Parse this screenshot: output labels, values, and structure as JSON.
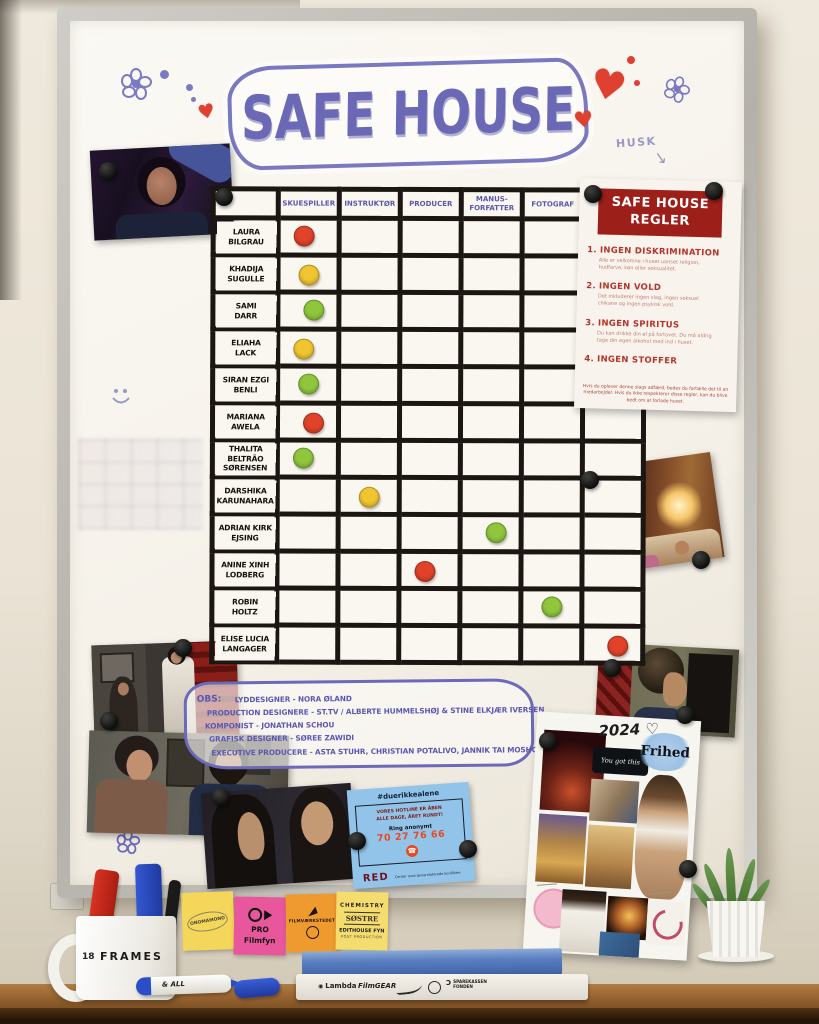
{
  "board": {
    "title": "SAFE HOUSE",
    "husk_label": "HUSK",
    "grid": {
      "columns": [
        "SKUESPILLER",
        "INSTRUKTØR",
        "PRODUCER",
        "MANUS-\nFORFATTER",
        "FOTOGRAF",
        "KLIPPER"
      ],
      "rows": [
        {
          "name": "LAURA\nBILGRAU",
          "dot": {
            "col": 0,
            "color": "#e0432a"
          }
        },
        {
          "name": "KHADIJA\nSUGULLE",
          "dot": {
            "col": 0,
            "color": "#f0c531"
          }
        },
        {
          "name": "SAMI\nDARR",
          "dot": {
            "col": 0,
            "color": "#8fc63c"
          }
        },
        {
          "name": "ELIAHA\nLACK",
          "dot": {
            "col": 0,
            "color": "#f0c531"
          }
        },
        {
          "name": "SIRAN EZGI\nBENLI",
          "dot": {
            "col": 0,
            "color": "#8fc63c"
          }
        },
        {
          "name": "MARIANA\nAWELA",
          "dot": {
            "col": 0,
            "color": "#e0432a"
          }
        },
        {
          "name": "THALITA BELTRÃO\nSØRENSEN",
          "dot": {
            "col": 0,
            "color": "#8fc63c"
          }
        },
        {
          "name": "DARSHIKA\nKARUNAHARA",
          "dot": {
            "col": 1,
            "color": "#f0c531"
          }
        },
        {
          "name": "ADRIAN KIRK\nEJSING",
          "dot": {
            "col": 3,
            "color": "#8fc63c"
          }
        },
        {
          "name": "ANINE XINH\nLODBERG",
          "dot": {
            "col": 2,
            "color": "#e0432a"
          }
        },
        {
          "name": "ROBIN\nHOLTZ",
          "dot": {
            "col": 4,
            "color": "#8fc63c"
          }
        },
        {
          "name": "ELISE LUCIA\nLANGAGER",
          "dot": {
            "col": 5,
            "color": "#e0432a"
          }
        }
      ]
    },
    "obs_note": {
      "label": "OBS:",
      "lines": [
        "LYDDESIGNER - NORA ØLAND",
        "PRODUCTION DESIGNERE - ST.TV / ALBERTE HUMMELSHØJ & STINE ELKJÆR IVERSEN",
        "KOMPONIST - JONATHAN SCHOU",
        "GRAFISK DESIGNER - SØREE ZAWIDI",
        "EXECUTIVE PRODUCERE - ASTA STUHR, CHRISTIAN POTALIVO, JANNIK TAI MOSHOLT & ANNA MARINA SKOVRUS"
      ]
    }
  },
  "rules_poster": {
    "title": "SAFE HOUSE REGLER",
    "rules": [
      {
        "num": "1.",
        "title": "INGEN DISKRIMINATION",
        "sub": "Alle er velkomne i huset uanset religion, hudfarve, køn eller seksualitet."
      },
      {
        "num": "2.",
        "title": "INGEN VOLD",
        "sub": "Det inkluderer ingen slag, ingen seksuel chikane og ingen psykisk vold."
      },
      {
        "num": "3.",
        "title": "INGEN SPIRITUS",
        "sub": "Du kan drikke din øl på fortovet. Du må aldrig tage din egen alkohol med ind i huset."
      },
      {
        "num": "4.",
        "title": "INGEN STOFFER",
        "sub": ""
      }
    ],
    "footnote": "Hvis du oplever denne slags adfærd, bedes du fortælle det til en medarbejder. Hvis du ikke respekterer disse regler, kan du blive bedt om at forlade huset."
  },
  "hotline_card": {
    "hashtag": "#duerikkealene",
    "line1": "VORES HOTLINE ER ÅBEN",
    "line2": "ALLE DAGE, ÅRET RUNDT!",
    "ring_label": "Ring anonymt",
    "phone": "70 27 76 66",
    "phone_icon": "☎",
    "org": "RED",
    "org_tagline": "Center mod æresrelaterede konflikter"
  },
  "collage": {
    "year": "2024",
    "heart": "♡",
    "headline": "Frihed",
    "quote": "You got this"
  },
  "sticky_notes": {
    "note1": "ONOMAMONO",
    "note2_line1": "PRO",
    "note2_line2": "Filmfyn",
    "note3": "FILMVÆRKSTEDET",
    "note4_line1": "CHEMISTRY",
    "note4_line2": "SØSTRE",
    "note4_line3": "EDITHOUSE FYN",
    "note4_line4": "POST PRODUCTION"
  },
  "desk": {
    "mug_number": "18",
    "mug_brand": "FRAMES",
    "marker_text": "& ALL",
    "spine_lambda": "Lambda",
    "spine_filmgear": "FilmGEAR",
    "spine_fund": "SPAREKASSEN\nFONDEN"
  }
}
